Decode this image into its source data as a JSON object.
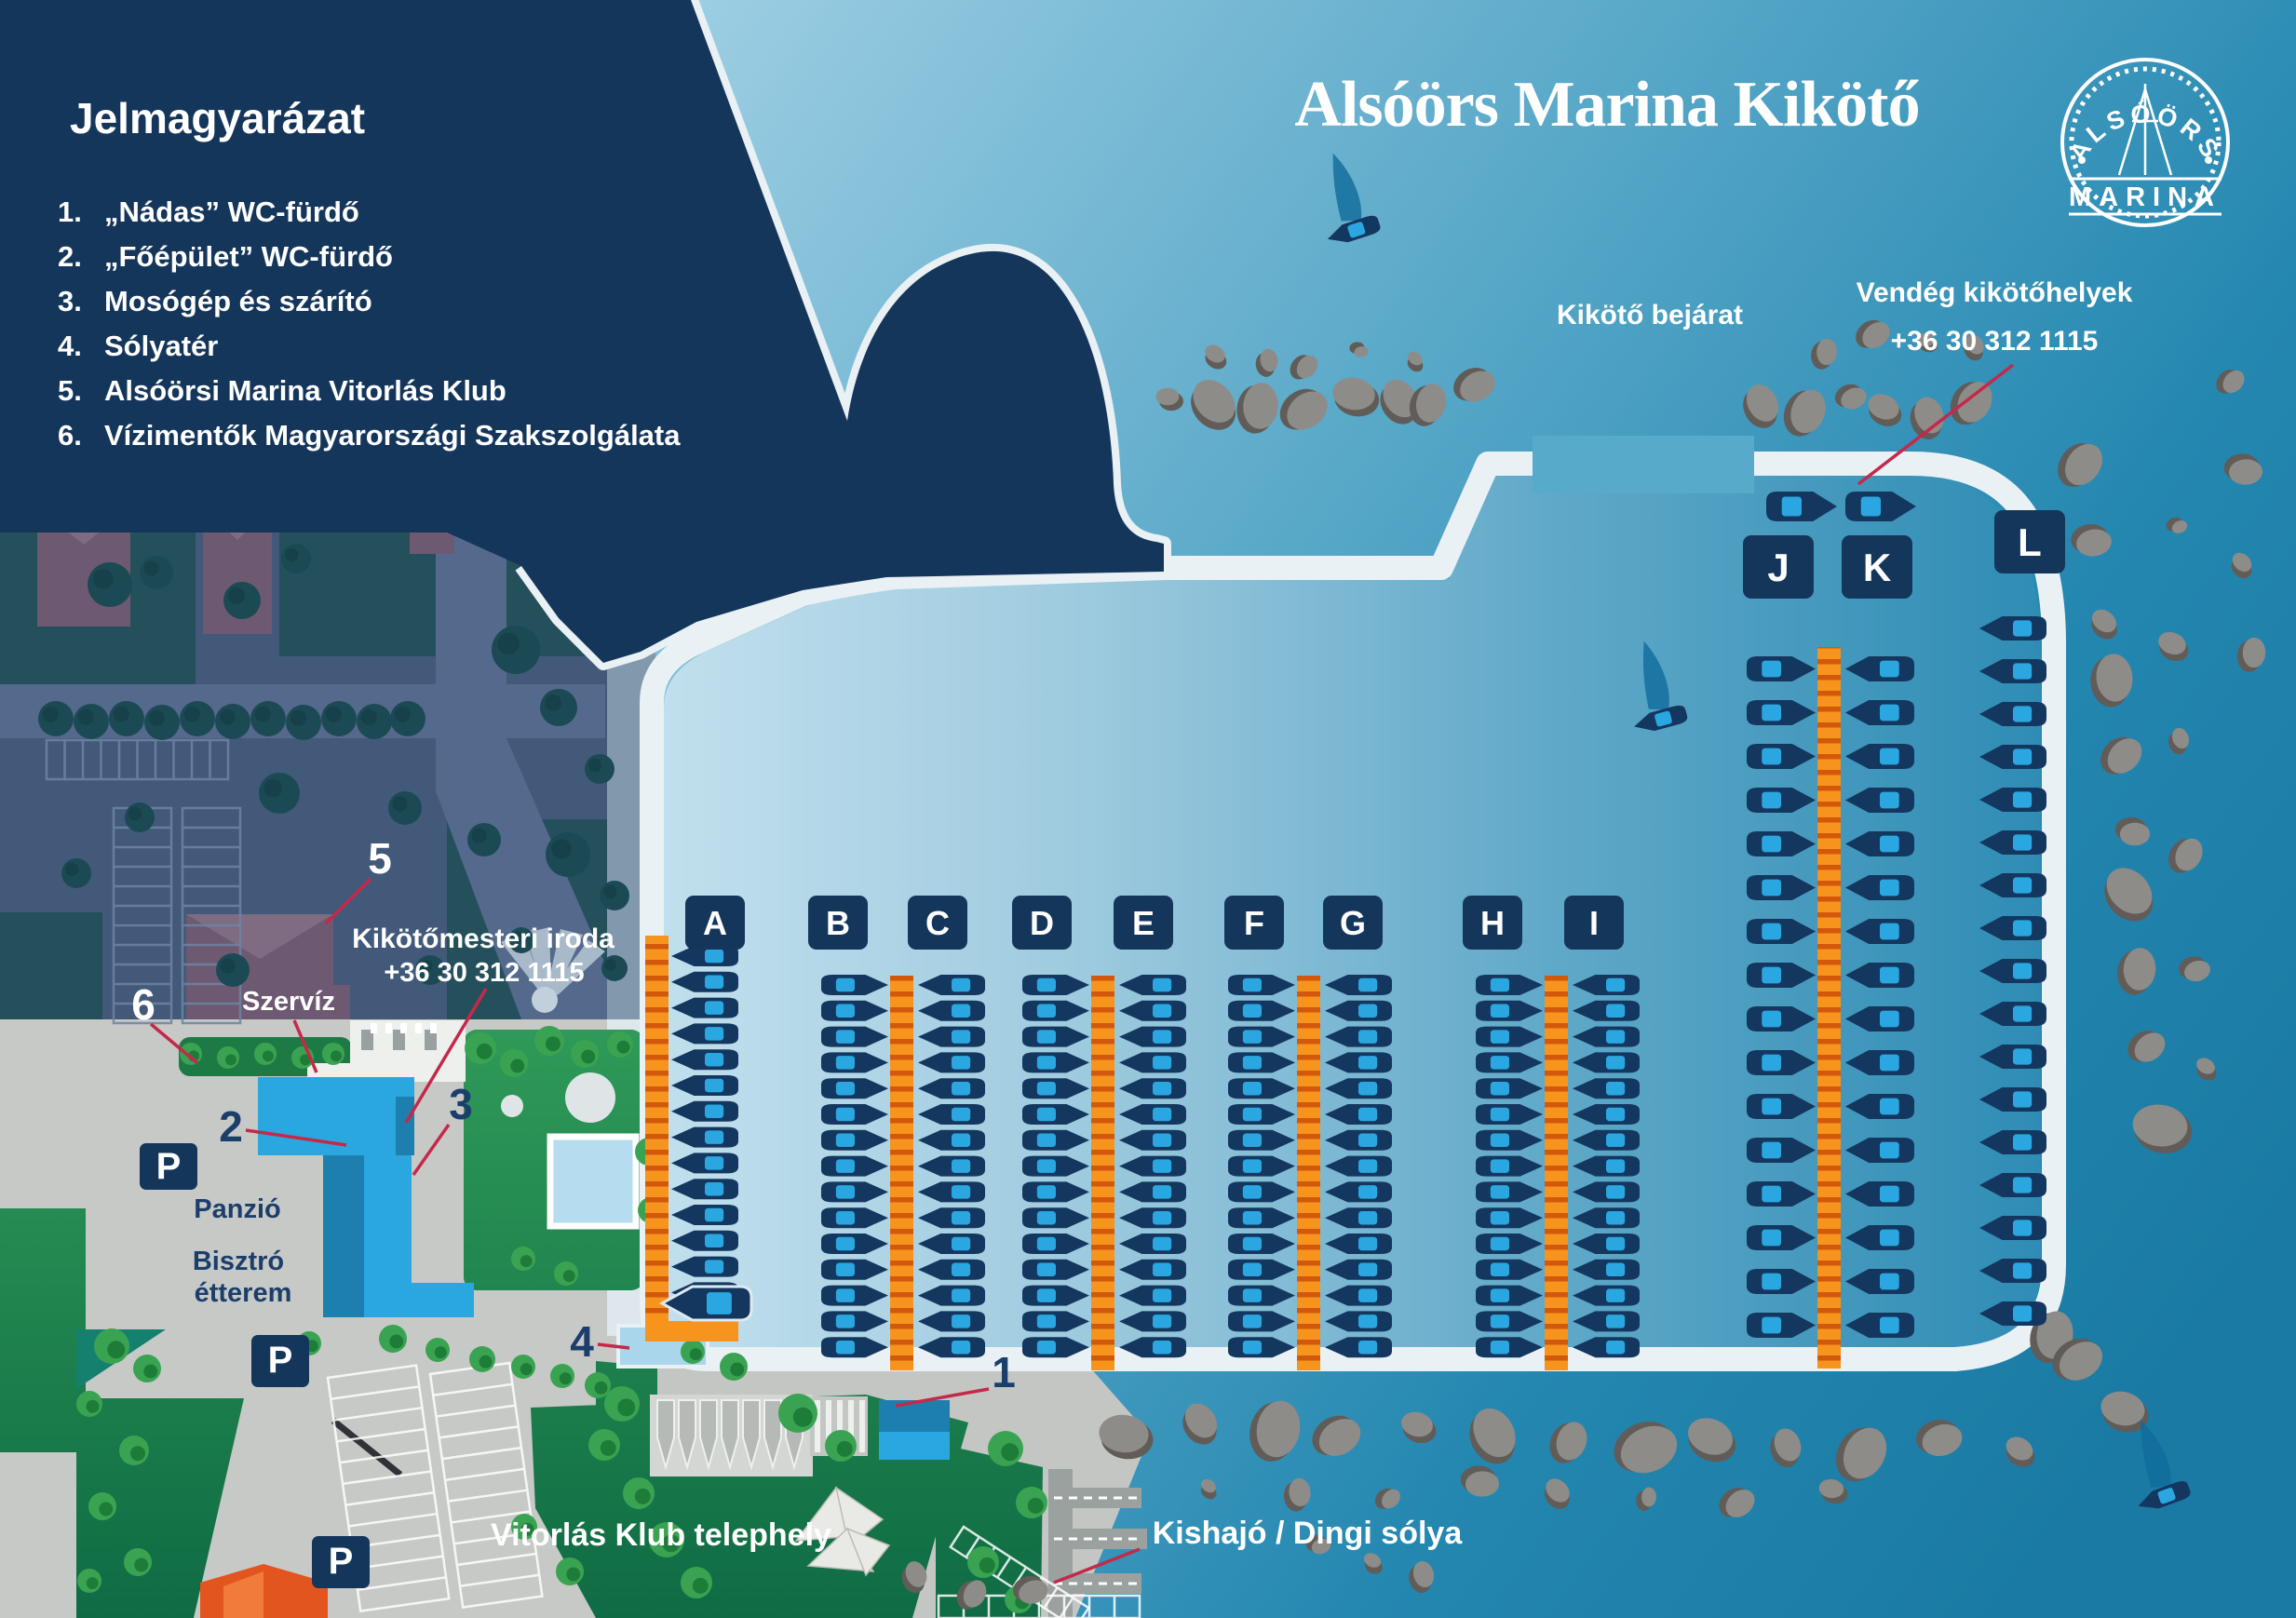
{
  "legend": {
    "title": "Jelmagyarázat",
    "items": [
      {
        "num": "1.",
        "text": "„Nádas” WC-fürdő"
      },
      {
        "num": "2.",
        "text": "„Főépület” WC-fürdő"
      },
      {
        "num": "3.",
        "text": "Mosógép és szárító"
      },
      {
        "num": "4.",
        "text": "Sólyatér"
      },
      {
        "num": "5.",
        "text": "Alsóörsi Marina Vitorlás Klub"
      },
      {
        "num": "6.",
        "text": "Vízimentők Magyarországi Szakszolgálata"
      }
    ]
  },
  "header": {
    "title": "Alsóörs Marina Kikötő"
  },
  "logo": {
    "arc_text": "ALSÓÖRS",
    "band_text": "MARINA"
  },
  "map_labels": {
    "harbor_entrance": "Kikötő bejárat",
    "guest_berths_line1": "Vendég kikötőhelyek",
    "guest_berths_line2": "+36 30 312  1115",
    "harbor_master_line1": "Kikötőmesteri iroda",
    "harbor_master_line2": "+36 30 312  1115",
    "service": "Szervíz",
    "guesthouse": "Panzió",
    "bistro_line1": "Bisztró",
    "bistro_line2": "étterem",
    "sailing_club_site": "Vitorlás Klub telephely",
    "dinghy_slipway": "Kishajó / Dingi sólya",
    "parking": "P"
  },
  "map_numbers": [
    "1",
    "2",
    "3",
    "4",
    "5",
    "6"
  ],
  "marina": {
    "docks": [
      {
        "letter": "A",
        "boats": 15,
        "facing": "left"
      },
      {
        "letter": "B",
        "boats": 15,
        "facing": "right"
      },
      {
        "letter": "C",
        "boats": 15,
        "facing": "left"
      },
      {
        "letter": "D",
        "boats": 15,
        "facing": "right"
      },
      {
        "letter": "E",
        "boats": 15,
        "facing": "left"
      },
      {
        "letter": "F",
        "boats": 15,
        "facing": "right"
      },
      {
        "letter": "G",
        "boats": 15,
        "facing": "left"
      },
      {
        "letter": "H",
        "boats": 15,
        "facing": "right"
      },
      {
        "letter": "I",
        "boats": 15,
        "facing": "left"
      },
      {
        "letter": "J",
        "boats": 16,
        "facing": "right"
      },
      {
        "letter": "K",
        "boats": 16,
        "facing": "left"
      },
      {
        "letter": "L",
        "boats": 17,
        "facing": "left"
      }
    ],
    "guest_boats": 2,
    "sailing_boats": 3
  },
  "colors": {
    "navy": "#15365b",
    "orange": "#f7941e",
    "orange_dark": "#d2590b",
    "boat_hull": "#14375f",
    "boat_cabin": "#2aa7e0",
    "water_outer_light": "#a6d3e6",
    "water_outer_dark": "#1a7aa3",
    "basin_light": "#c2e0ee",
    "basin_dark": "#2e8cb4",
    "quay": "#e9f1f5",
    "leader_red": "#c4294a",
    "rock": "#8e8c88",
    "rock_dark": "#615c57",
    "label_navy": "#1c3e6b"
  }
}
